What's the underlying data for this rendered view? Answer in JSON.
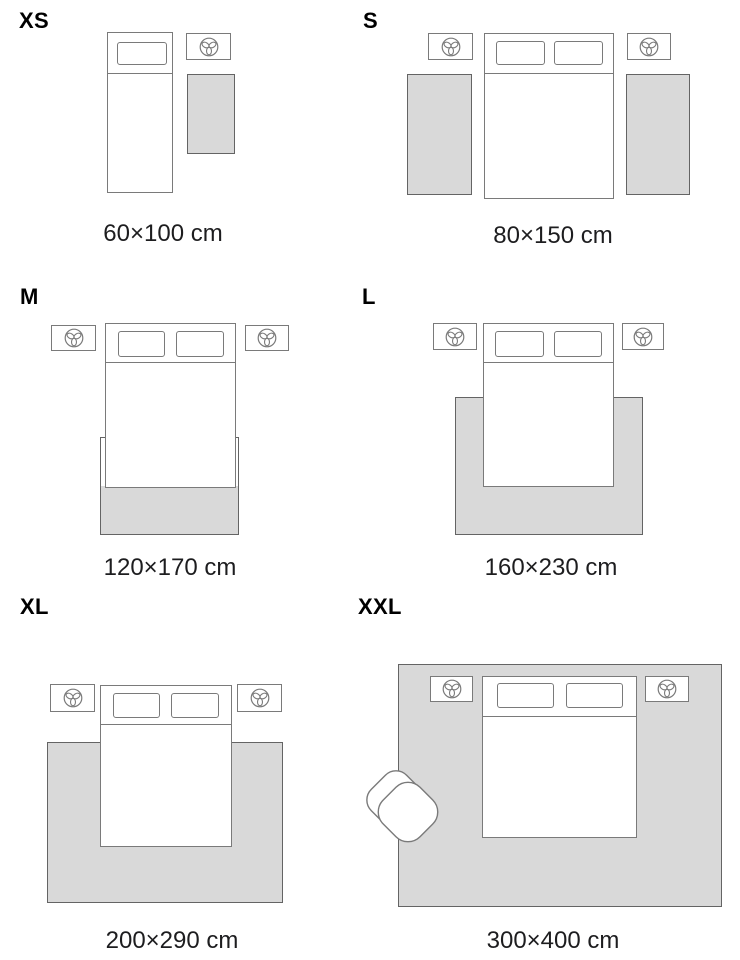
{
  "panels": [
    {
      "id": "xs",
      "label": "XS",
      "caption": "60×100 cm"
    },
    {
      "id": "s",
      "label": "S",
      "caption": "80×150 cm"
    },
    {
      "id": "m",
      "label": "M",
      "caption": "120×170 cm"
    },
    {
      "id": "l",
      "label": "L",
      "caption": "160×230 cm"
    },
    {
      "id": "xl",
      "label": "XL",
      "caption": "200×290 cm"
    },
    {
      "id": "xxl",
      "label": "XXL",
      "caption": "300×400 cm"
    }
  ],
  "icons": {
    "nightstand_decor": "plant-trefoil-icon",
    "armchair": "armchair-top-view"
  },
  "colors": {
    "rug_fill": "#d9d9d9",
    "rug_border": "#646464",
    "line": "#7a7a7a",
    "label": "#000000",
    "caption": "#1d1d1f",
    "bg": "#ffffff"
  }
}
